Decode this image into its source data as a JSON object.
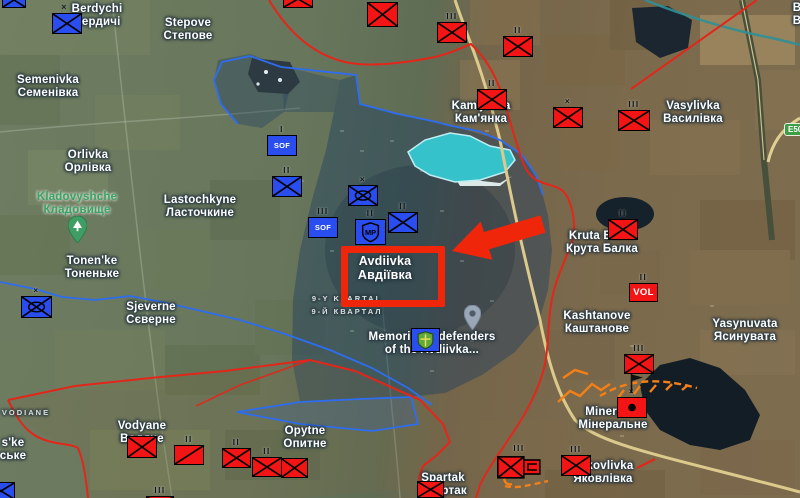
{
  "colors": {
    "blue_unit": "#2a4df0",
    "red_unit": "#f31515",
    "annotation_red": "#ef2609",
    "fort_orange": "#f57f17",
    "green_label": "#3aa363",
    "front_line_red": "#e3261a",
    "blue_line": "#2e6df0",
    "road_tan": "#dcc98c",
    "lake_teal": "#35c2cb"
  },
  "road_shield": {
    "label": "E50",
    "x": 784,
    "y": 123
  },
  "highlight": {
    "target_en": "Avdiivka",
    "target_uk": "Авдіївка"
  },
  "labels": [
    {
      "id": "berdychi",
      "l1": "Berdychi",
      "l2": "Бердичі",
      "x": 97,
      "y": 3,
      "cls": "place"
    },
    {
      "id": "berdychi-cross",
      "l1": "×",
      "l2": "",
      "x": 64,
      "y": 1,
      "cls": "tiny-x"
    },
    {
      "id": "stepove",
      "l1": "Stepove",
      "l2": "Степове",
      "x": 188,
      "y": 17,
      "cls": "place"
    },
    {
      "id": "semenivka",
      "l1": "Semenivka",
      "l2": "Семенівка",
      "x": 48,
      "y": 74,
      "cls": "place"
    },
    {
      "id": "orlivka",
      "l1": "Orlivka",
      "l2": "Орлівка",
      "x": 88,
      "y": 149,
      "cls": "place"
    },
    {
      "id": "kladovyshche",
      "l1": "Kladovyshche",
      "l2": "Кладовище",
      "x": 77,
      "y": 191,
      "cls": "place-green"
    },
    {
      "id": "lastochkyne",
      "l1": "Lastochkyne",
      "l2": "Ласточкине",
      "x": 200,
      "y": 194,
      "cls": "place"
    },
    {
      "id": "tonenke",
      "l1": "Tonen'ke",
      "l2": "Тоненьке",
      "x": 92,
      "y": 255,
      "cls": "place"
    },
    {
      "id": "sjeverne",
      "l1": "Sjeverne",
      "l2": "Сєверне",
      "x": 151,
      "y": 301,
      "cls": "place"
    },
    {
      "id": "kamjanka",
      "l1": "Kam'janka",
      "l2": "Кам'янка",
      "x": 481,
      "y": 100,
      "cls": "place"
    },
    {
      "id": "vasylivka",
      "l1": "Vasylivka",
      "l2": "Василівка",
      "x": 693,
      "y": 100,
      "cls": "place"
    },
    {
      "id": "kruta-balka",
      "l1": "Kruta Balka",
      "l2": "Крута Балка",
      "x": 602,
      "y": 230,
      "cls": "place"
    },
    {
      "id": "kashtanove",
      "l1": "Kashtanove",
      "l2": "Каштанове",
      "x": 597,
      "y": 310,
      "cls": "place"
    },
    {
      "id": "yasynuvata",
      "l1": "Yasynuvata",
      "l2": "Ясинувата",
      "x": 745,
      "y": 318,
      "cls": "place"
    },
    {
      "id": "avdiivka",
      "l1": "Avdiivka",
      "l2": "Авдіївка",
      "x": 385,
      "y": 255,
      "cls": "place-lg"
    },
    {
      "id": "kvartal",
      "l1": "9-Y KVARTAL",
      "l2": "9-Й КВАРТАЛ",
      "x": 347,
      "y": 293,
      "cls": "area-caps"
    },
    {
      "id": "memorial",
      "l1": "Memorial to defenders",
      "l2": "of the Avdiivka...",
      "x": 432,
      "y": 331,
      "cls": "place"
    },
    {
      "id": "mineralne",
      "l1": "Mineralne",
      "l2": "Мінеральне",
      "x": 613,
      "y": 406,
      "cls": "place"
    },
    {
      "id": "yakovlivka",
      "l1": "Yakovlivka",
      "l2": "Яковлівка",
      "x": 603,
      "y": 460,
      "cls": "place"
    },
    {
      "id": "vodyane",
      "l1": "Vodyane",
      "l2": "Водяне",
      "x": 142,
      "y": 420,
      "cls": "place"
    },
    {
      "id": "vodiane-area",
      "l1": "VODIANE",
      "l2": "",
      "x": 26,
      "y": 407,
      "cls": "area-caps"
    },
    {
      "id": "opytne",
      "l1": "Opytne",
      "l2": "Опитне",
      "x": 305,
      "y": 425,
      "cls": "place"
    },
    {
      "id": "spartak",
      "l1": "Spartak",
      "l2": "Спартак",
      "x": 443,
      "y": 472,
      "cls": "place"
    },
    {
      "id": "ske-partial",
      "l1": "s'ke",
      "l2": "ське",
      "x": 13,
      "y": 437,
      "cls": "place"
    },
    {
      "id": "edge-partial",
      "l1": "В",
      "l2": "В",
      "x": 797,
      "y": 2,
      "cls": "place"
    }
  ],
  "units": [
    {
      "side": "blue",
      "sym": "x",
      "ech": "",
      "x": 2,
      "y": -8,
      "w": 24,
      "h": 16
    },
    {
      "side": "blue",
      "sym": "x",
      "ech": "",
      "x": 52,
      "y": 13,
      "w": 30,
      "h": 21
    },
    {
      "side": "blue",
      "sym": "sof",
      "ech": "I",
      "x": 267,
      "y": 135,
      "w": 30,
      "h": 21
    },
    {
      "side": "blue",
      "sym": "x",
      "ech": "II",
      "x": 272,
      "y": 176,
      "w": 30,
      "h": 21
    },
    {
      "side": "blue",
      "sym": "mech",
      "ech": "×",
      "x": 348,
      "y": 185,
      "w": 30,
      "h": 21
    },
    {
      "side": "blue",
      "sym": "sof",
      "ech": "III",
      "x": 308,
      "y": 217,
      "w": 30,
      "h": 21
    },
    {
      "side": "blue",
      "sym": "mp",
      "ech": "II",
      "x": 355,
      "y": 219,
      "w": 31,
      "h": 26
    },
    {
      "side": "blue",
      "sym": "x",
      "ech": "II",
      "x": 388,
      "y": 212,
      "w": 30,
      "h": 21
    },
    {
      "side": "blue",
      "sym": "mech",
      "ech": "×",
      "x": 21,
      "y": 296,
      "w": 31,
      "h": 22
    },
    {
      "side": "blue",
      "sym": "memorial",
      "ech": "",
      "x": 411,
      "y": 328,
      "w": 29,
      "h": 24
    },
    {
      "side": "blue",
      "sym": "x",
      "ech": "",
      "x": -13,
      "y": 482,
      "w": 28,
      "h": 18
    },
    {
      "side": "red",
      "sym": "x",
      "ech": "",
      "x": 283,
      "y": -10,
      "w": 30,
      "h": 18
    },
    {
      "side": "red",
      "sym": "x",
      "ech": "",
      "x": 367,
      "y": 2,
      "w": 31,
      "h": 25
    },
    {
      "side": "red",
      "sym": "x",
      "ech": "III",
      "x": 437,
      "y": 22,
      "w": 30,
      "h": 21
    },
    {
      "side": "red",
      "sym": "x",
      "ech": "II",
      "x": 503,
      "y": 36,
      "w": 30,
      "h": 21
    },
    {
      "side": "red",
      "sym": "x",
      "ech": "II",
      "x": 477,
      "y": 89,
      "w": 30,
      "h": 21
    },
    {
      "side": "red",
      "sym": "x",
      "ech": "×",
      "x": 553,
      "y": 107,
      "w": 30,
      "h": 21
    },
    {
      "side": "red",
      "sym": "x",
      "ech": "III",
      "x": 618,
      "y": 110,
      "w": 32,
      "h": 21
    },
    {
      "side": "red",
      "sym": "x",
      "ech": "II",
      "x": 608,
      "y": 219,
      "w": 30,
      "h": 21
    },
    {
      "side": "red",
      "sym": "vol",
      "ech": "II",
      "x": 629,
      "y": 283,
      "w": 29,
      "h": 19
    },
    {
      "side": "red",
      "sym": "x",
      "ech": "III",
      "x": 624,
      "y": 354,
      "w": 30,
      "h": 20
    },
    {
      "side": "red",
      "sym": "dot",
      "ech": "×",
      "x": 617,
      "y": 397,
      "w": 30,
      "h": 21
    },
    {
      "side": "red",
      "sym": "x",
      "ech": "III",
      "x": 561,
      "y": 455,
      "w": 30,
      "h": 21
    },
    {
      "side": "red",
      "sym": "combo",
      "ech": "III",
      "x": 497,
      "y": 455,
      "w": 44,
      "h": 24
    },
    {
      "side": "red",
      "sym": "x",
      "ech": "",
      "x": 127,
      "y": 436,
      "w": 30,
      "h": 22
    },
    {
      "side": "red",
      "sym": "diag",
      "ech": "II",
      "x": 174,
      "y": 445,
      "w": 30,
      "h": 20
    },
    {
      "side": "red",
      "sym": "x",
      "ech": "II",
      "x": 222,
      "y": 448,
      "w": 29,
      "h": 20
    },
    {
      "side": "red",
      "sym": "x",
      "ech": "II",
      "x": 252,
      "y": 457,
      "w": 30,
      "h": 20
    },
    {
      "side": "red",
      "sym": "x",
      "ech": "",
      "x": 281,
      "y": 458,
      "w": 27,
      "h": 20
    },
    {
      "side": "red",
      "sym": "x",
      "ech": "",
      "x": 417,
      "y": 481,
      "w": 27,
      "h": 17
    },
    {
      "side": "red",
      "sym": "x",
      "ech": "III",
      "x": 146,
      "y": 496,
      "w": 28,
      "h": 16
    }
  ],
  "pins": [
    {
      "type": "park-tree",
      "x": 68,
      "y": 216
    },
    {
      "type": "generic",
      "x": 464,
      "y": 305
    },
    {
      "type": "flag",
      "x": 630,
      "y": 374
    }
  ]
}
